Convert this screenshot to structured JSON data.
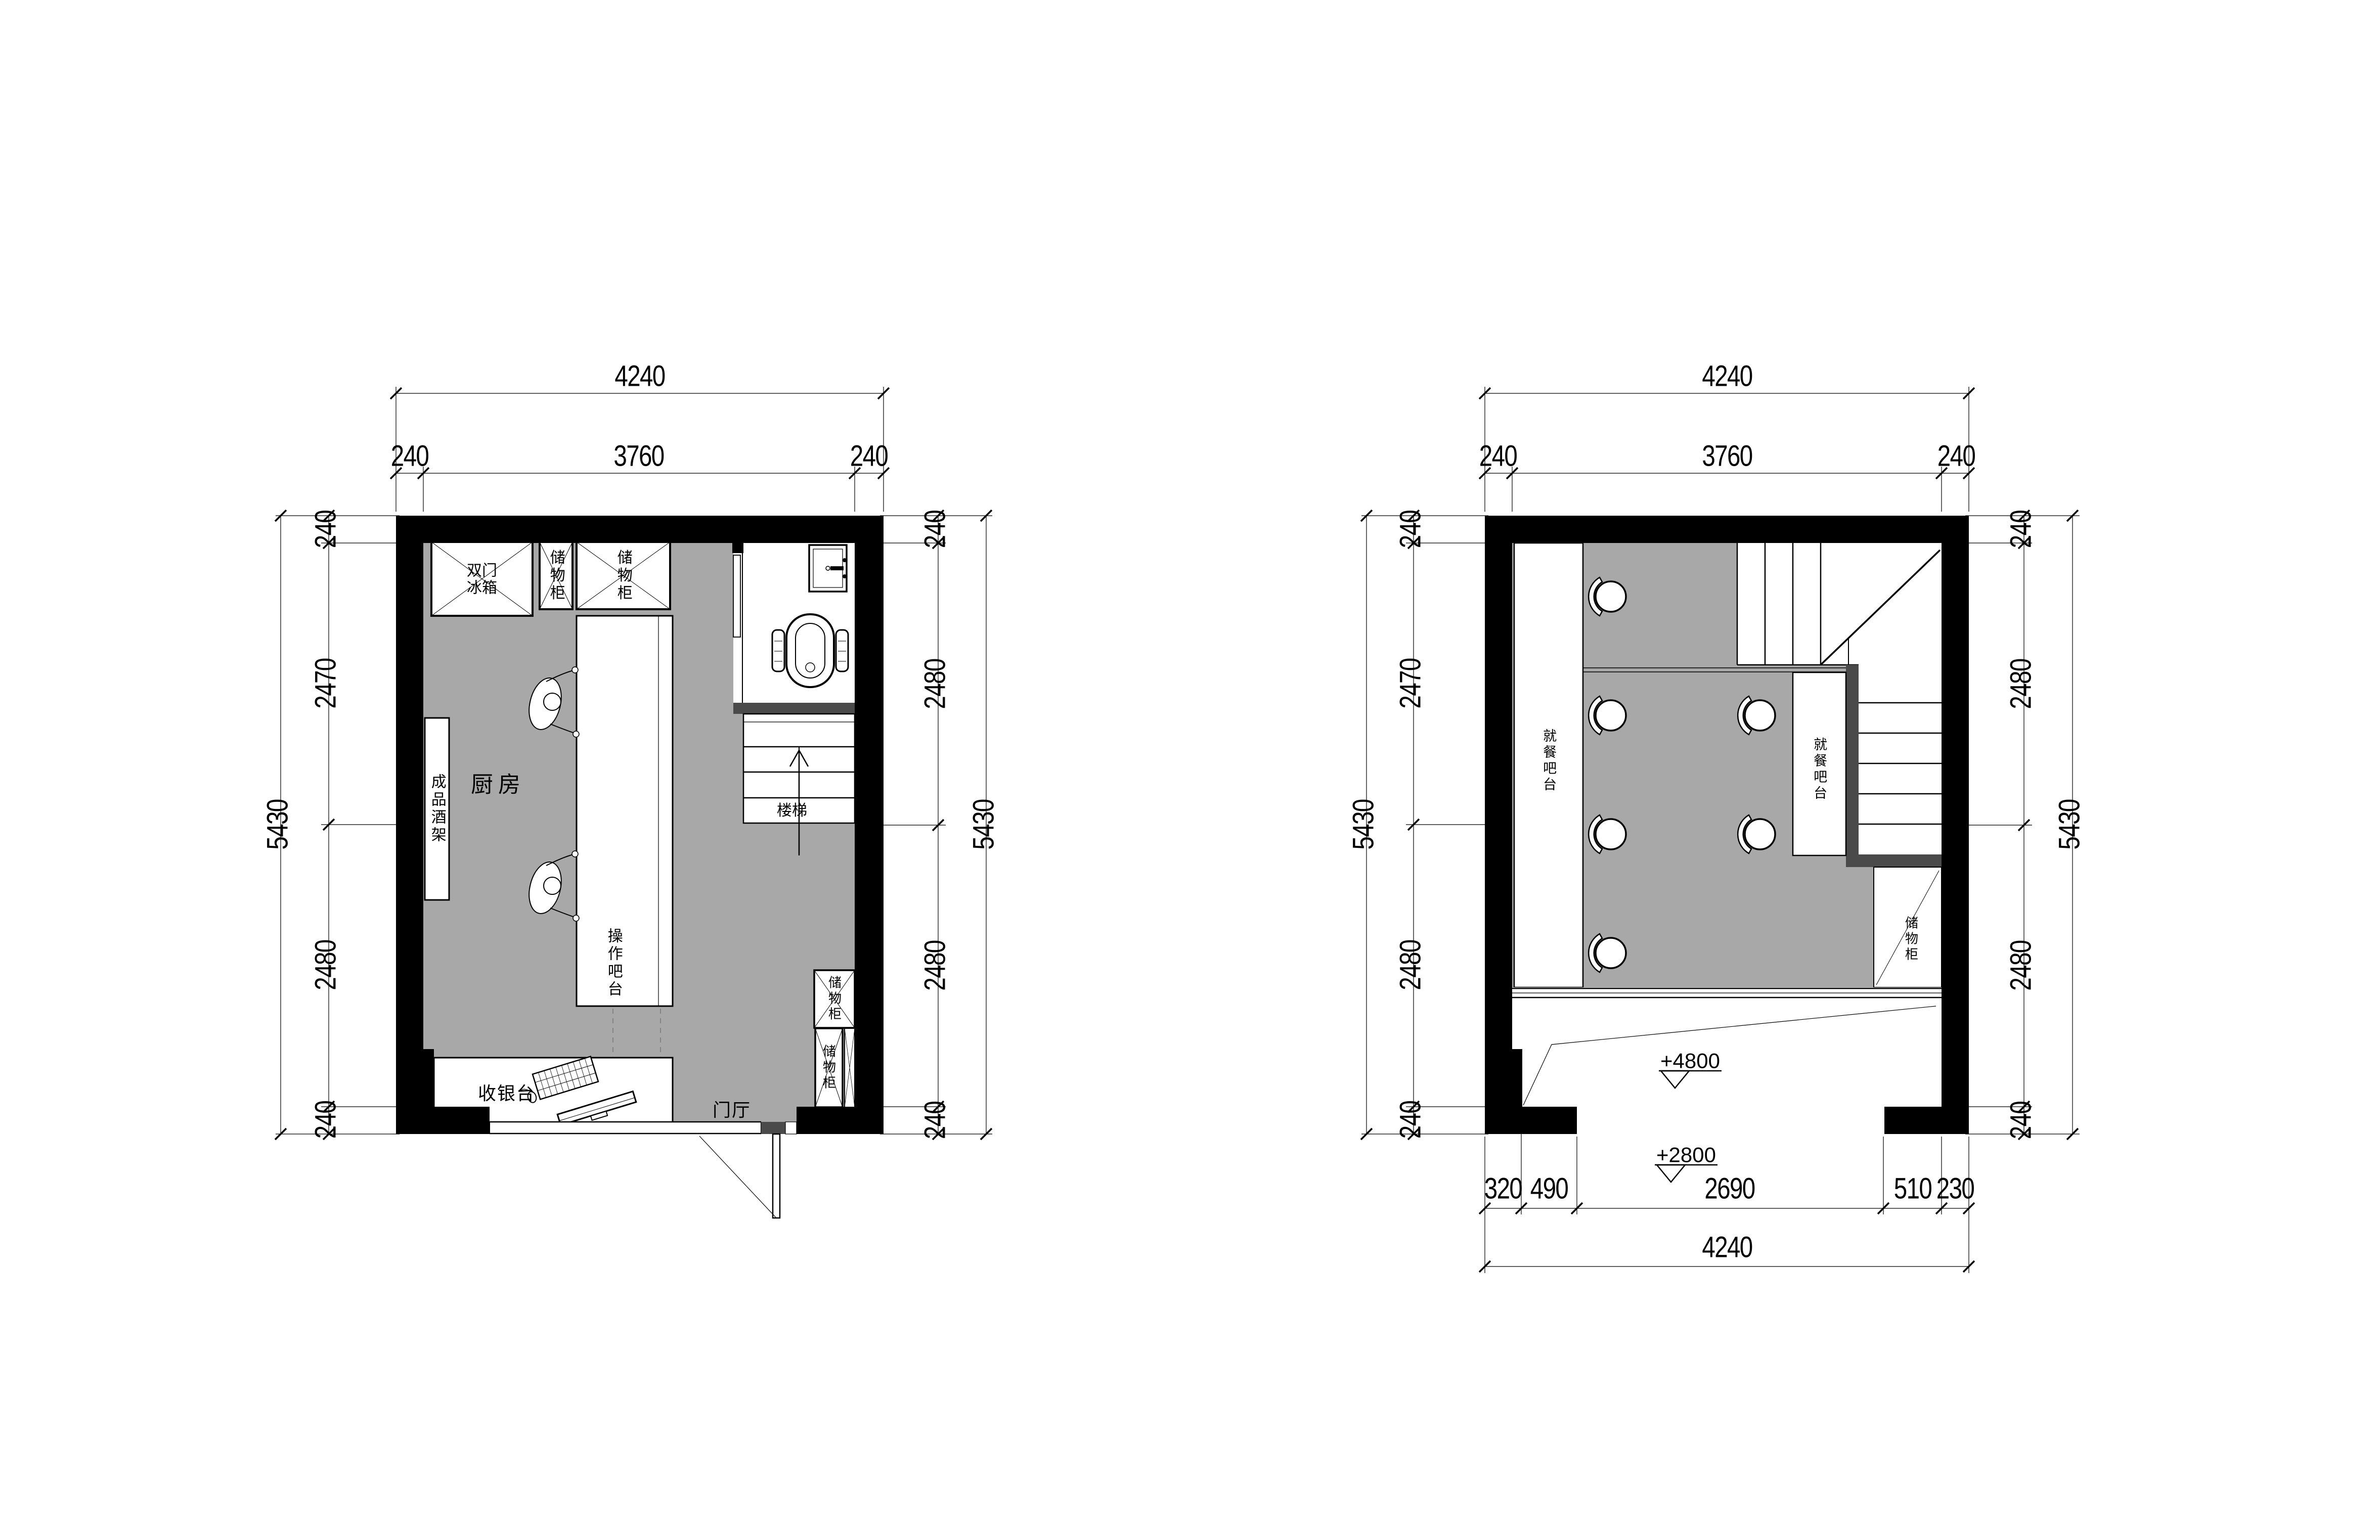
{
  "page": {
    "background": "#ffffff",
    "line_color": "#000000",
    "floor_color": "#a8a8a8",
    "partition_color": "#4a4a4a"
  },
  "plans": {
    "first": {
      "dims": {
        "top_total": "4240",
        "top": [
          "240",
          "3760",
          "240"
        ],
        "left": [
          "240",
          "2470",
          "2480",
          "240"
        ],
        "left_total": "5430",
        "right": [
          "240",
          "2480",
          "2480",
          "240"
        ],
        "right_total": "5430"
      },
      "labels": {
        "kitchen": "厨房",
        "foyer": "门厅",
        "stair": "楼梯",
        "fridge": "双门\n冰箱",
        "cabinet_top_small": "储物柜",
        "cabinet_top_large": "储物柜",
        "wine_rack": "成品酒架",
        "work_bar": "操作吧台",
        "cashier": "收银台",
        "cabinet_right_upper": "储物柜",
        "cabinet_right_lower": "储物柜"
      }
    },
    "second": {
      "dims": {
        "top_total": "4240",
        "top": [
          "240",
          "3760",
          "240"
        ],
        "left": [
          "240",
          "2470",
          "2480",
          "240"
        ],
        "left_total": "5430",
        "right": [
          "240",
          "2480",
          "2480",
          "240"
        ],
        "right_total": "5430",
        "bottom": [
          "320",
          "490",
          "2690",
          "510",
          "230"
        ],
        "bottom_total": "4240"
      },
      "labels": {
        "dining_bar_left": "就餐吧台",
        "dining_bar_mid": "就餐吧台",
        "storage_cabinet": "储物柜",
        "level_upper": "+4800",
        "level_lower": "+2800"
      }
    }
  }
}
